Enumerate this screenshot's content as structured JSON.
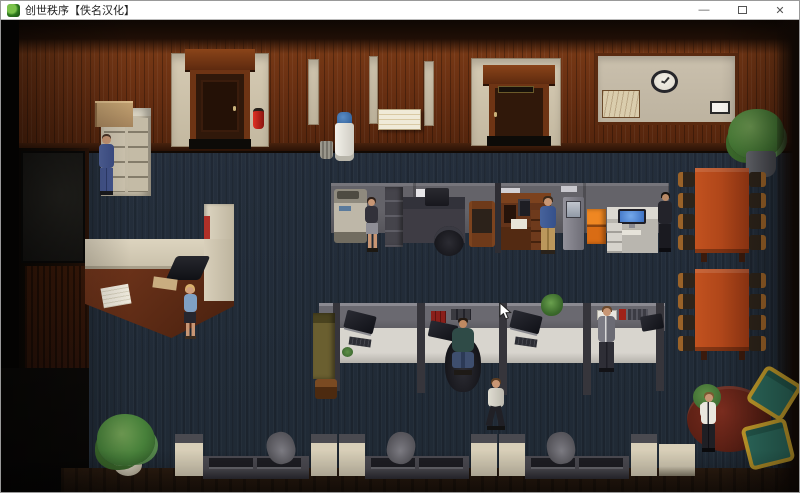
{
  "window": {
    "title": "创世秩序【佚名汉化】",
    "controls": {
      "minimize": "—",
      "maximize": "",
      "close": "✕"
    }
  },
  "colors": {
    "titlebar_bg": "#ffffff",
    "carpet": "#232d3a",
    "wood_wall": "#6a3012",
    "wall_panel_beige": "#c3b8a0",
    "door_brown": "#2f1708",
    "partition_gray": "#615f66",
    "desk_white": "#d6d3cc",
    "cabinet_orange": "#e2761c",
    "monitor_screen_blue": "#4a86d8",
    "conference_table": "#b2441c",
    "armchair_teal": "#2e6e60",
    "armchair_frame_gold": "#c9a12c",
    "extinguisher_red": "#c22218"
  }
}
